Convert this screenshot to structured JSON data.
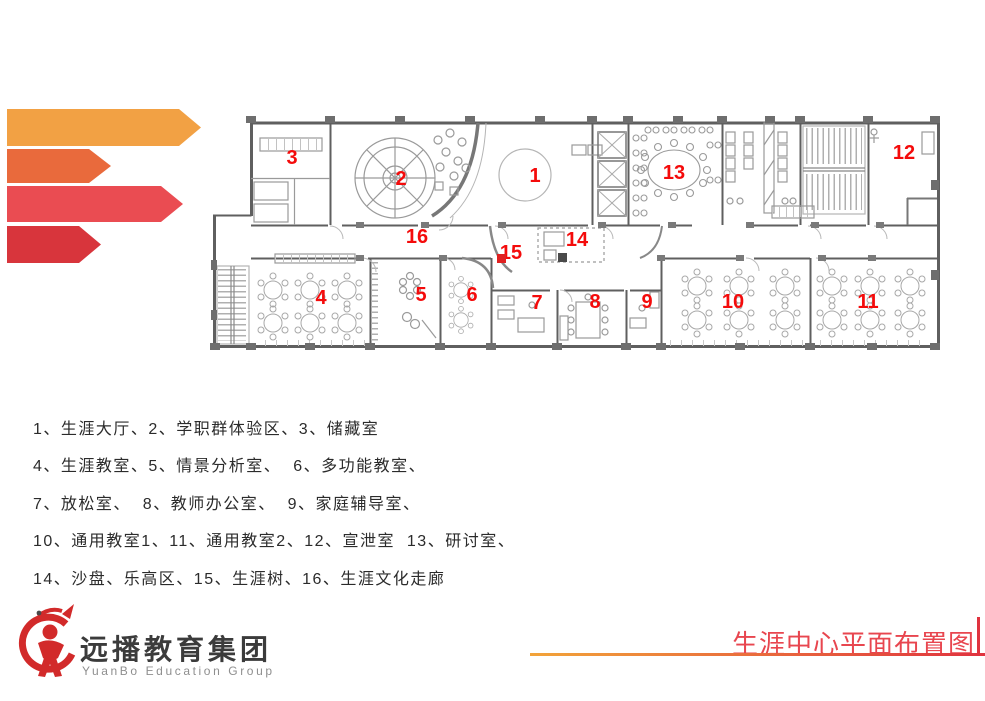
{
  "ribbons": [
    {
      "name": "ribbon-1",
      "color": "#F2A144"
    },
    {
      "name": "ribbon-2",
      "color": "#E96A3C"
    },
    {
      "name": "ribbon-3",
      "color": "#EA4C52"
    },
    {
      "name": "ribbon-4",
      "color": "#D8353C"
    }
  ],
  "plan": {
    "label_color": "#f40b0b",
    "labels": [
      {
        "id": "1",
        "x": 325,
        "y": 156
      },
      {
        "id": "2",
        "x": 191,
        "y": 159
      },
      {
        "id": "3",
        "x": 82,
        "y": 138
      },
      {
        "id": "4",
        "x": 111,
        "y": 278
      },
      {
        "id": "5",
        "x": 211,
        "y": 275
      },
      {
        "id": "6",
        "x": 262,
        "y": 275
      },
      {
        "id": "7",
        "x": 327,
        "y": 283
      },
      {
        "id": "8",
        "x": 385,
        "y": 282
      },
      {
        "id": "9",
        "x": 437,
        "y": 282
      },
      {
        "id": "10",
        "x": 523,
        "y": 282
      },
      {
        "id": "11",
        "x": 658,
        "y": 282
      },
      {
        "id": "12",
        "x": 694,
        "y": 133
      },
      {
        "id": "13",
        "x": 464,
        "y": 153
      },
      {
        "id": "14",
        "x": 367,
        "y": 220
      },
      {
        "id": "15",
        "x": 301,
        "y": 233
      },
      {
        "id": "16",
        "x": 207,
        "y": 217
      }
    ],
    "markers": [
      {
        "name": "career-tree-marker",
        "x": 287,
        "y": 234,
        "w": 9,
        "h": 9,
        "color": "#e02020"
      },
      {
        "name": "sand-table-marker",
        "x": 348,
        "y": 233,
        "w": 9,
        "h": 9,
        "color": "#4a4a4a"
      }
    ]
  },
  "legend": {
    "lines": [
      "1、生涯大厅、2、学职群体验区、3、储藏室",
      "4、生涯教室、5、情景分析室、  6、多功能教室、",
      "7、放松室、  8、教师办公室、  9、家庭辅导室、",
      "10、通用教室1、11、通用教室2、12、宣泄室  13、研讨室、",
      "14、沙盘、乐高区、15、生涯树、16、生涯文化走廊"
    ]
  },
  "logo": {
    "name_cn": "远播教育集团",
    "name_en": "YuanBo Education Group",
    "emblem_color": "#D22A2A"
  },
  "footer": {
    "title": "生涯中心平面布置图",
    "title_color": "#E8464F",
    "underline_from": "#F2A43A",
    "underline_to": "#E0333F"
  }
}
